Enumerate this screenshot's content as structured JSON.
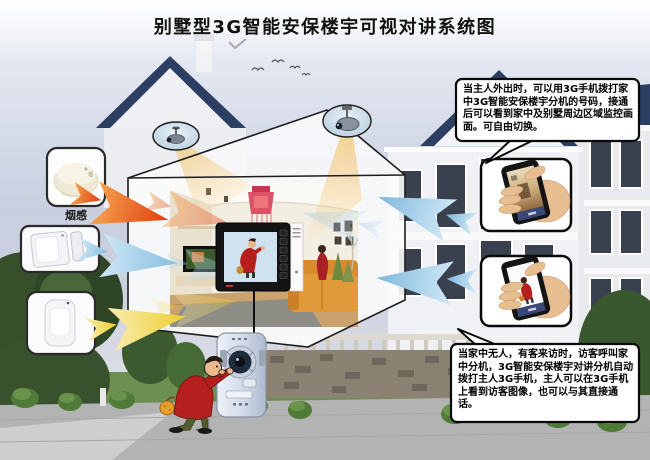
{
  "title": "别墅型3G智能安保楼宇可视对讲系统图",
  "callouts": {
    "owner_away": "当主人外出时，可以用3G手机拨打家中3G智能安保楼宇分机的号码，接通后可以看到家中及别墅周边区域监控画面。可自由切换。",
    "visitor_call": "当家中无人，有客来访时，访客呼叫家中分机，3G智能安保楼宇对讲分机自动拨打主人3G手机，主人可以在3G手机上看到访客图像，也可以与其直接通话。"
  },
  "sensors": {
    "smoke_label": "烟感",
    "smoke_icon": "smoke-detector-icon",
    "door_icon": "door-magnet-sensor-icon",
    "infrared_icon": "infrared-sensor-icon"
  },
  "diagram": {
    "house_cameras": [
      "ceiling-camera-icon",
      "ceiling-camera-icon"
    ],
    "indoor_unit": "video-intercom-monitor-icon",
    "door_station": "outdoor-intercom-icon",
    "visitor": "visitor-cartoon-icon",
    "phones": [
      {
        "icon": "phone-in-hand-icon",
        "screen_shows": "home-interior-view"
      },
      {
        "icon": "phone-in-hand-icon",
        "screen_shows": "visitor-image-view"
      }
    ],
    "signal_arrows_left": [
      "red",
      "blue",
      "yellow"
    ],
    "signal_arrows_right": [
      "blue",
      "blue"
    ]
  },
  "colors": {
    "sky_top": "#eef0f6",
    "sky_mid": "#c9cfe0",
    "roof_blue": "#2c3f63",
    "arrow_red": "#df3d10",
    "arrow_blue": "#9dcdea",
    "arrow_yellow": "#eece2a",
    "beam_yellow": "#f3cd86",
    "visitor_coat": "#b5201e",
    "phone_band": "#3a4878"
  }
}
